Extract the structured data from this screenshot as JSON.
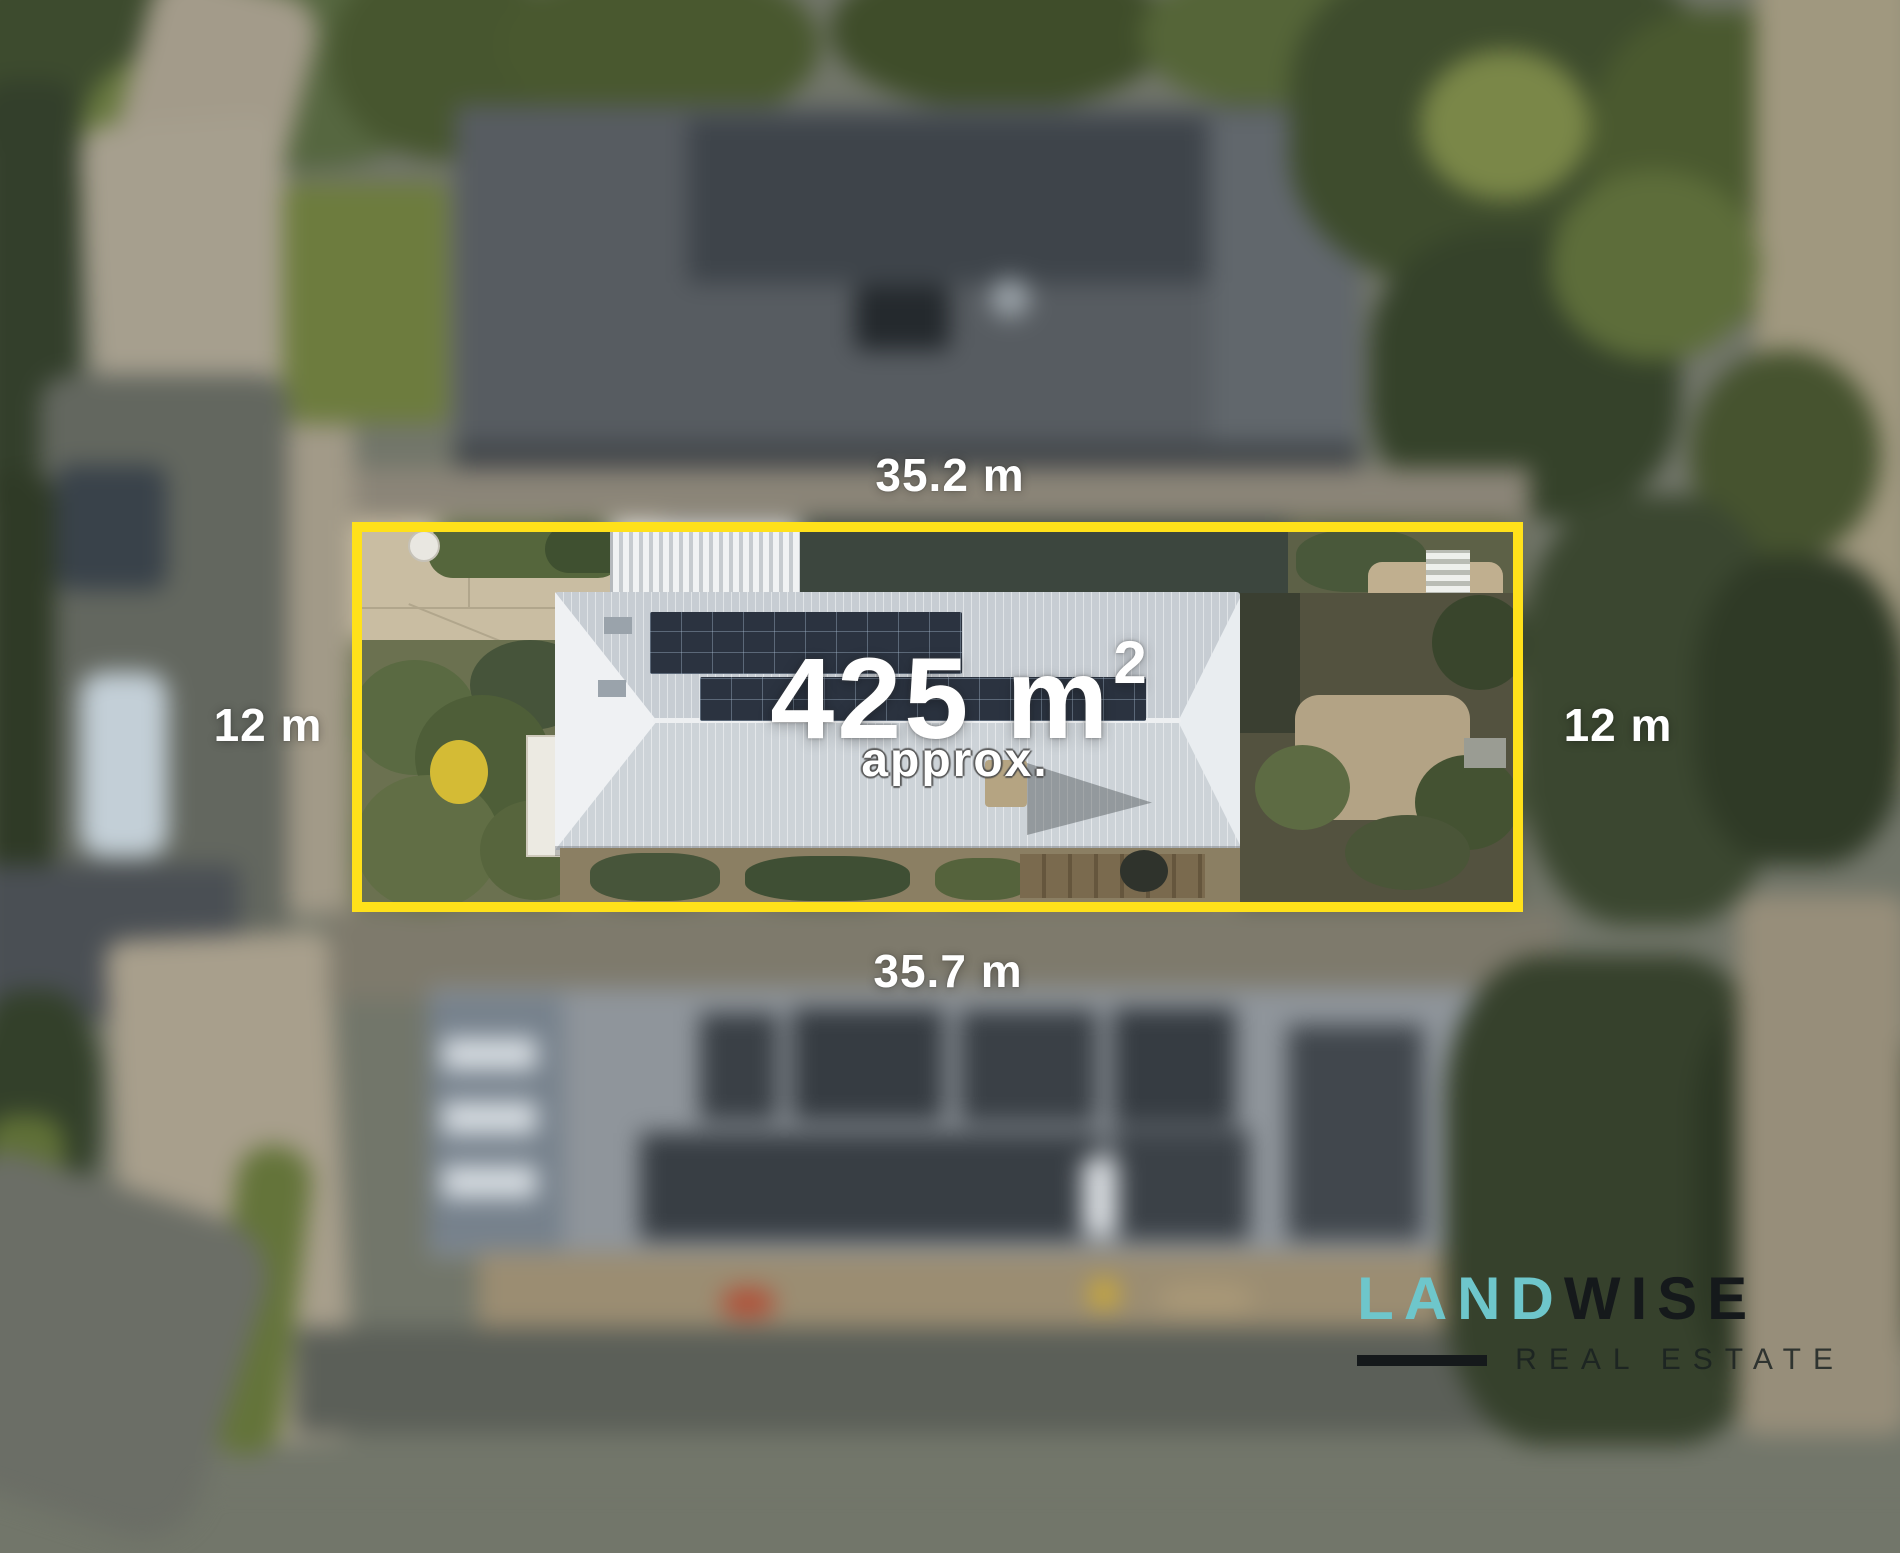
{
  "overlay": {
    "top_width_label": "35.2 m",
    "bottom_width_label": "35.7 m",
    "left_depth_label": "12 m",
    "right_depth_label": "12 m",
    "area_value": "425 m",
    "area_exponent": "2",
    "area_qualifier": "approx."
  },
  "logo": {
    "brand_part1": "LAND",
    "brand_part2": "WISE",
    "tagline": "REAL ESTATE"
  },
  "colors": {
    "boundary_yellow": "#ffe11a",
    "logo_teal": "#6ec6cb",
    "logo_dark": "#15191b",
    "label_white": "#ffffff"
  }
}
